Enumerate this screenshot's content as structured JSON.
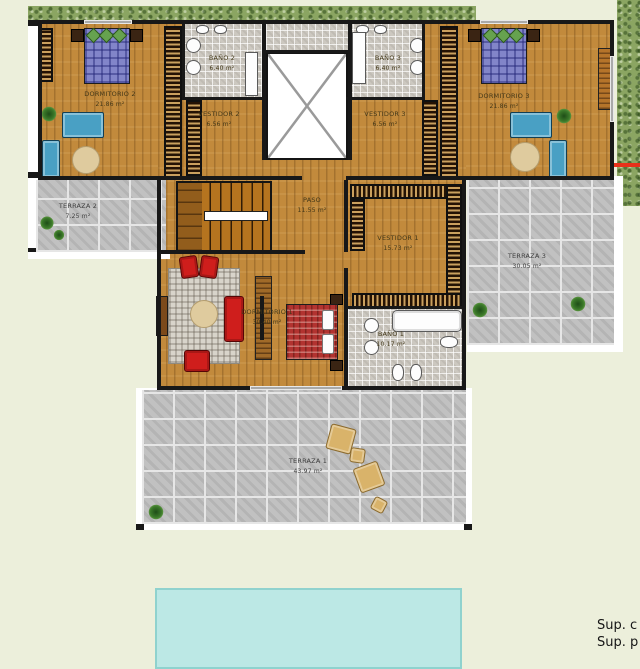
{
  "rooms": {
    "dormitorio2": {
      "name": "DORMITORIO 2",
      "area": "21.86 m²"
    },
    "bano2": {
      "name": "BAÑO 2",
      "area": "6.40 m²"
    },
    "vestidor2": {
      "name": "VESTIDOR 2",
      "area": "6.56 m²"
    },
    "bano3": {
      "name": "BAÑO 3",
      "area": "6.40 m²"
    },
    "vestidor3": {
      "name": "VESTIDOR 3",
      "area": "6.56 m²"
    },
    "dormitorio3": {
      "name": "DORMITORIO 3",
      "area": "21.86 m²"
    },
    "paso": {
      "name": "PASO",
      "area": "11.55 m²"
    },
    "vestidor1": {
      "name": "VESTIDOR 1",
      "area": "15.73 m²"
    },
    "dormitorio1": {
      "name": "DORMITORIO 1",
      "area": "30.40 m²"
    },
    "bano1": {
      "name": "BAÑO 1",
      "area": "10.17 m²"
    },
    "terraza2": {
      "name": "TERRAZA 2",
      "area": "7.25 m²"
    },
    "terraza3": {
      "name": "TERRAZA 3",
      "area": "30.05 m²"
    },
    "terraza1": {
      "name": "TERRAZA 1",
      "area": "43.97 m²"
    }
  },
  "notes": {
    "line1": "Sup. c",
    "line2": "Sup. p"
  },
  "colors": {
    "background": "#ecefdb",
    "wood_floor": "#c28a3c",
    "stone_paving": "#c1c1c1",
    "bath_tile": "#ccc8c0",
    "wall": "#181818",
    "hedge_green": "#8ba562",
    "pool_water": "#bce8e5",
    "bed_blue": "#8285c9",
    "bed_red": "#b23330",
    "sofa_blue": "#49a0c4",
    "chair_red": "#cf1e1c",
    "marker_red": "#e8311a"
  }
}
